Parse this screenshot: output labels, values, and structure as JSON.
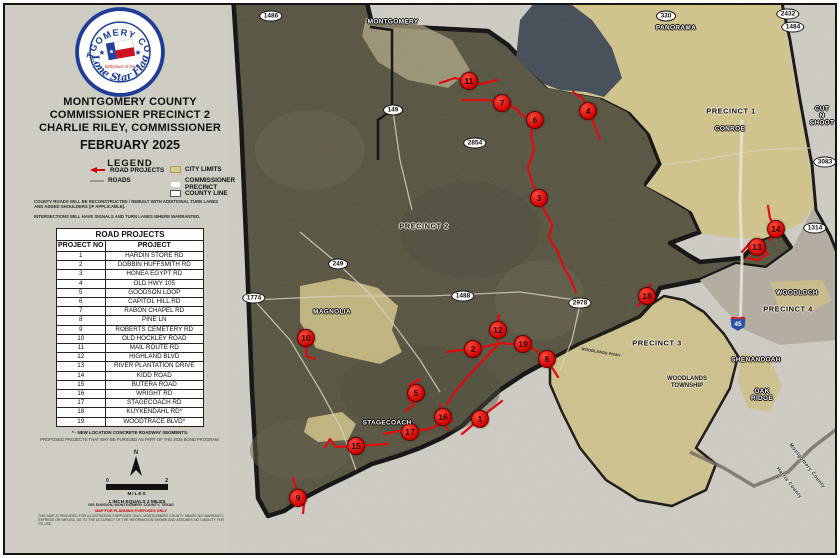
{
  "panel": {
    "seal": {
      "ring_top": "MONTGOMERY COUNTY",
      "ring_bottom": "Lone Star Flag",
      "center_small": "Birthplace of the"
    },
    "title_line1": "MONTGOMERY COUNTY",
    "title_line2": "COMMISSIONER PRECINCT 2",
    "title_line3": "CHARLIE RILEY, COMMISSIONER",
    "date": "FEBRUARY 2025",
    "legend": {
      "heading": "LEGEND",
      "road_projects": "ROAD PROJECTS",
      "roads": "ROADS",
      "city_limits": "CITY LIMITS",
      "commissioner_precinct": "COMMISSIONER\nPRECINCT",
      "county_line": "COUNTY LINE"
    },
    "notes": [
      "COUNTY ROADS WILL BE RECONSTRUCTED / REBUILT WITH ADDITIONAL TURN LANES AND ADDED SHOULDERS (IF APPLICABLE).",
      "INTERSECTIONS WILL HAVE SIGNALS AND TURN LANES WHERE WARRANTED."
    ],
    "table": {
      "title": "ROAD PROJECTS",
      "col1": "PROJECT NO",
      "col2": "PROJECT",
      "rows": [
        [
          "1",
          "HARDIN STORE RD"
        ],
        [
          "2",
          "DOBBIN HUFFSMITH RD"
        ],
        [
          "3",
          "HONEA EGYPT RD"
        ],
        [
          "4",
          "OLD HWY 105"
        ],
        [
          "5",
          "GOODSON LOOP"
        ],
        [
          "6",
          "CAPITOL HILL RD"
        ],
        [
          "7",
          "RABON CHAPEL RD"
        ],
        [
          "8",
          "PINE LN"
        ],
        [
          "9",
          "ROBERTS CEMETERY RD"
        ],
        [
          "10",
          "OLD HOCKLEY ROAD"
        ],
        [
          "11",
          "MAIL ROUTE RD"
        ],
        [
          "12",
          "HIGHLAND BLVD"
        ],
        [
          "13",
          "RIVER PLANTATION DRIVE"
        ],
        [
          "14",
          "KIDD ROAD"
        ],
        [
          "15",
          "BUTERA ROAD"
        ],
        [
          "16",
          "WRIGHT RD"
        ],
        [
          "17",
          "STAGECOACH RD"
        ],
        [
          "18",
          "KUYKENDAHL RD*"
        ],
        [
          "19",
          "WOODTRACE BLVD*"
        ]
      ]
    },
    "footnote1": "* - NEW LOCATION CONCRETE ROADWAY SEGMENTS.",
    "footnote2": "PROPOSED PROJECTS THAT MAY BE PURSUED AS PART OF THE 2025 BOND PROGRAM.",
    "north_label": "N",
    "scale": {
      "left": "0",
      "right": "2",
      "unit": "MILES",
      "ratio": "1 INCH EQUALS 2 MILES"
    },
    "credits": {
      "source": "GIS DIVISION, MONTGOMERY COUNTY, TEXAS",
      "red_note": "MAP FOR PLANNING PURPOSES ONLY",
      "disclaimer": "THIS MAP IS PROVIDED FOR ILLUSTRATION PURPOSES ONLY. MONTGOMERY COUNTY MAKES NO WARRANTY, EXPRESS OR IMPLIED, AS TO THE ACCURACY OF THE INFORMATION SHOWN AND ASSUMES NO LIABILITY FOR ITS USE."
    }
  },
  "map": {
    "interstate": {
      "label": "45",
      "x": 738,
      "y": 323
    },
    "shields": [
      {
        "label": "1486",
        "x": 271,
        "y": 16
      },
      {
        "label": "330",
        "x": 666,
        "y": 16
      },
      {
        "label": "2432",
        "x": 788,
        "y": 14
      },
      {
        "label": "1484",
        "x": 793,
        "y": 27
      },
      {
        "label": "149",
        "x": 393,
        "y": 110
      },
      {
        "label": "2854",
        "x": 475,
        "y": 143
      },
      {
        "label": "3083",
        "x": 825,
        "y": 162
      },
      {
        "label": "1314",
        "x": 815,
        "y": 228
      },
      {
        "label": "249",
        "x": 338,
        "y": 264
      },
      {
        "label": "1774",
        "x": 254,
        "y": 298
      },
      {
        "label": "1488",
        "x": 463,
        "y": 296
      },
      {
        "label": "2978",
        "x": 580,
        "y": 303
      }
    ],
    "markers": [
      {
        "no": "1",
        "x": 480,
        "y": 419
      },
      {
        "no": "2",
        "x": 473,
        "y": 349
      },
      {
        "no": "3",
        "x": 539,
        "y": 198
      },
      {
        "no": "4",
        "x": 588,
        "y": 111
      },
      {
        "no": "5",
        "x": 416,
        "y": 393
      },
      {
        "no": "6",
        "x": 535,
        "y": 120
      },
      {
        "no": "7",
        "x": 502,
        "y": 103
      },
      {
        "no": "8",
        "x": 547,
        "y": 359
      },
      {
        "no": "9",
        "x": 298,
        "y": 498
      },
      {
        "no": "10",
        "x": 306,
        "y": 338
      },
      {
        "no": "11",
        "x": 469,
        "y": 81
      },
      {
        "no": "12",
        "x": 498,
        "y": 330
      },
      {
        "no": "13",
        "x": 757,
        "y": 247
      },
      {
        "no": "14",
        "x": 776,
        "y": 229
      },
      {
        "no": "15",
        "x": 356,
        "y": 446
      },
      {
        "no": "16",
        "x": 443,
        "y": 417
      },
      {
        "no": "17",
        "x": 410,
        "y": 432
      },
      {
        "no": "18",
        "x": 647,
        "y": 296
      },
      {
        "no": "19",
        "x": 523,
        "y": 344
      }
    ],
    "places": [
      {
        "name": "MONTGOMERY",
        "x": 393,
        "y": 22,
        "style": "city"
      },
      {
        "name": "PANORAMA",
        "x": 676,
        "y": 28,
        "style": "city"
      },
      {
        "name": "CONROE",
        "x": 730,
        "y": 129,
        "style": "city"
      },
      {
        "name": "CUT\nN\nSHOOT",
        "x": 822,
        "y": 116,
        "style": "city"
      },
      {
        "name": "MAGNOLIA",
        "x": 332,
        "y": 312,
        "style": "city"
      },
      {
        "name": "STAGECOACH",
        "x": 387,
        "y": 423,
        "style": "city"
      },
      {
        "name": "WOODLOCH",
        "x": 797,
        "y": 293,
        "style": "city"
      },
      {
        "name": "SHENANDOAH",
        "x": 756,
        "y": 360,
        "style": "city"
      },
      {
        "name": "OAK\nRIDGE",
        "x": 762,
        "y": 395,
        "style": "city"
      },
      {
        "name": "PRECINCT 1",
        "x": 731,
        "y": 111,
        "style": "precinct"
      },
      {
        "name": "PRECINCT 2",
        "x": 424,
        "y": 226,
        "style": "precinct"
      },
      {
        "name": "PRECINCT 3",
        "x": 657,
        "y": 343,
        "style": "precinct"
      },
      {
        "name": "PRECINCT 4",
        "x": 788,
        "y": 309,
        "style": "precinct"
      },
      {
        "name": "WOODLANDS\nTOWNSHIP",
        "x": 687,
        "y": 383,
        "style": "dark"
      },
      {
        "name": "WOODLANDS PKWY",
        "x": 601,
        "y": 352,
        "style": "road",
        "rotate": 10
      },
      {
        "name": "Montgomery County",
        "x": 807,
        "y": 466,
        "style": "county-lbl",
        "rotate": 52
      },
      {
        "name": "Harris County",
        "x": 789,
        "y": 483,
        "style": "county-lbl",
        "rotate": 52
      }
    ]
  },
  "colors": {
    "project_red": "#cf0000",
    "city_limits_tan": "#cdbf85",
    "precinct2_olive": "#55523e",
    "water": "#414a55",
    "interstate_blue": "#2a53a8"
  }
}
